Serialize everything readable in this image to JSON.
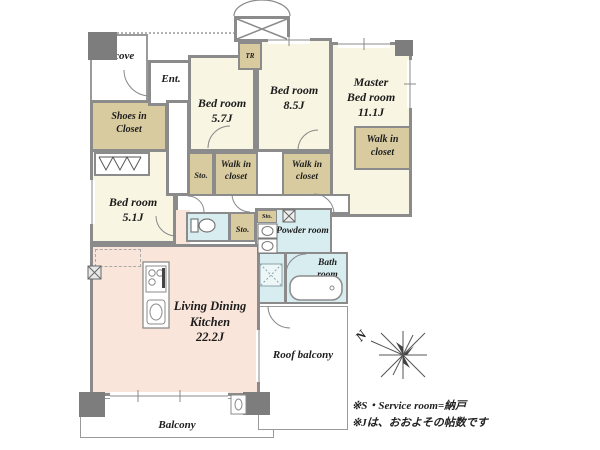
{
  "title": "apartment-floor-plan",
  "colors": {
    "bedroom_cream": "#f8f5e2",
    "closet_beige": "#d9cba0",
    "ldk_pink": "#f9e5da",
    "wet_area_blue": "#d8edf0",
    "wall_gray": "#8b8b8b",
    "pillar_gray": "#7d7d7d"
  },
  "rooms": {
    "alcove": "Alcove",
    "entrance": "Ent.",
    "shoes_closet_line1": "Shoes in",
    "shoes_closet_line2": "Closet",
    "trunk_room": "TR",
    "bedroom1_name": "Bed room",
    "bedroom1_size": "5.7J",
    "bedroom2_name": "Bed room",
    "bedroom2_size": "8.5J",
    "master_line1": "Master",
    "master_line2": "Bed room",
    "master_size": "11.1J",
    "bedroom3_name": "Bed room",
    "bedroom3_size": "5.1J",
    "walk_in_line1": "Walk in",
    "walk_in_line2": "closet",
    "storage": "Sto.",
    "ldk_line1": "Living Dining",
    "ldk_line2": "Kitchen",
    "ldk_size": "22.2J",
    "powder_room": "Powder room",
    "bath_line1": "Bath",
    "bath_line2": "room",
    "roof_balcony": "Roof balcony",
    "balcony": "Balcony"
  },
  "compass": {
    "north": "N"
  },
  "notes": {
    "line1": "※S・Service room=納戸",
    "line2": "※Jは、おおよその帖数です"
  }
}
